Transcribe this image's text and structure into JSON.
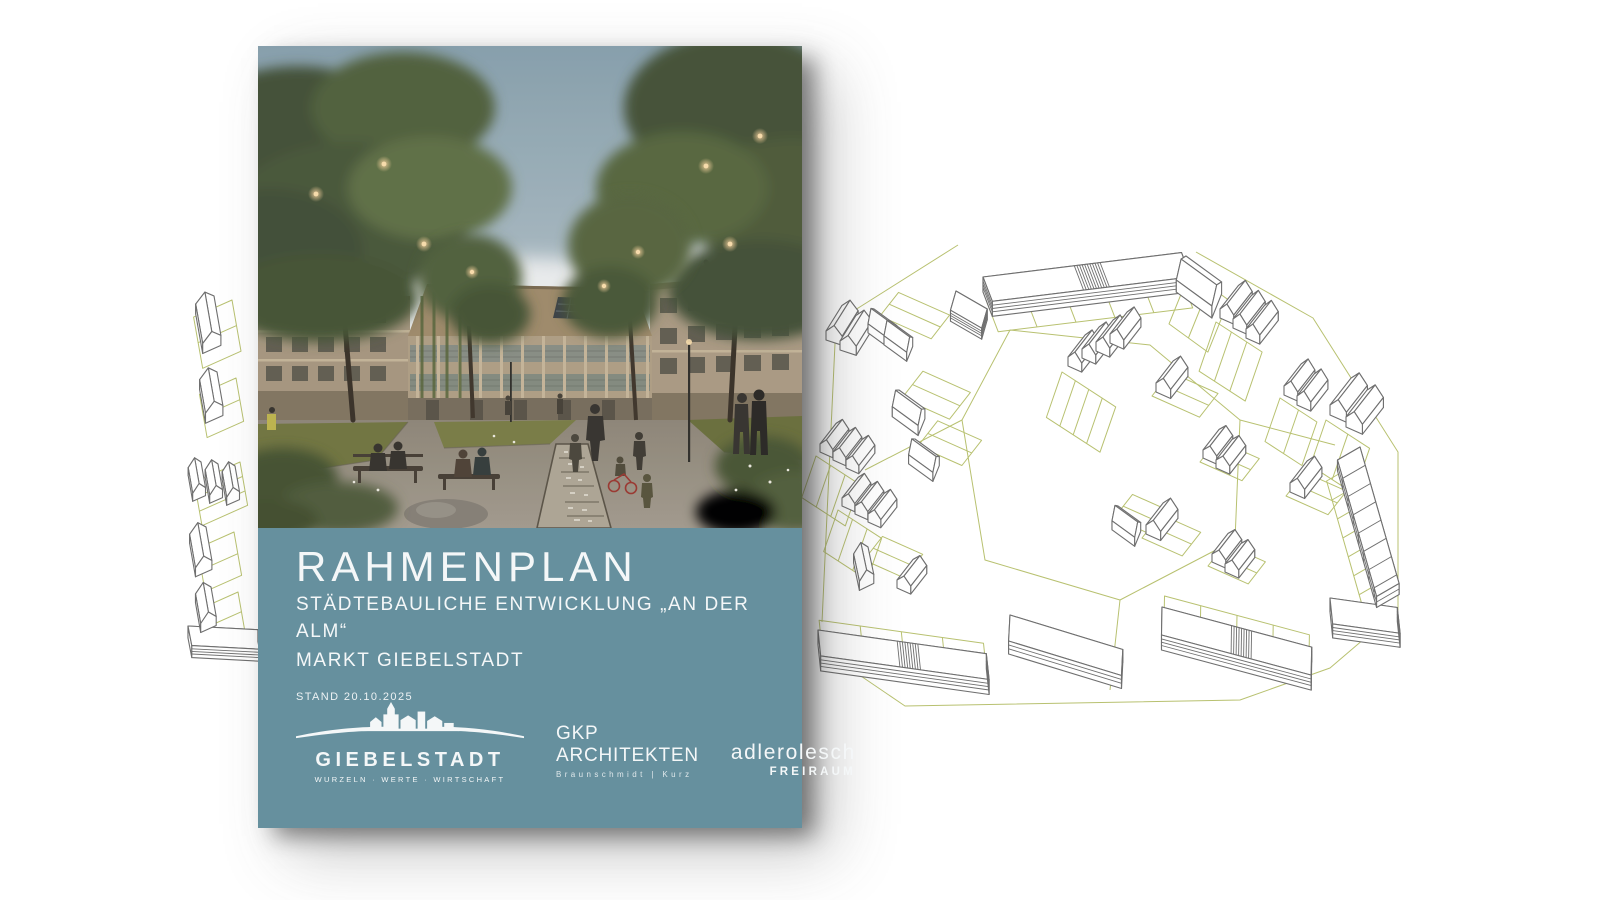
{
  "cover": {
    "title": "RAHMENPLAN",
    "subtitle_line1": "STÄDTEBAULICHE ENTWICKLUNG „AN DER ALM“",
    "subtitle_line2": "MARKT GIEBELSTADT",
    "date_line": "STAND 20.10.2025",
    "panel_color": "#66909E",
    "text_color": "#F4F7F8"
  },
  "logos": {
    "giebelstadt": {
      "name": "GIEBELSTADT",
      "tagline": "WURZELN · WERTE · WIRTSCHAFT"
    },
    "gkp": {
      "name": "GKP ARCHITEKTEN",
      "tagline": "Braunschmidt | Kurz"
    },
    "adlerolesch": {
      "name": "adlerolesch",
      "tagline": "FREIRAUM"
    }
  },
  "site_plan": {
    "description": "Isometric line drawing of the development site with parcel boundaries",
    "line_color": "#6F6F6F",
    "parcel_line_color": "#B8C170"
  }
}
